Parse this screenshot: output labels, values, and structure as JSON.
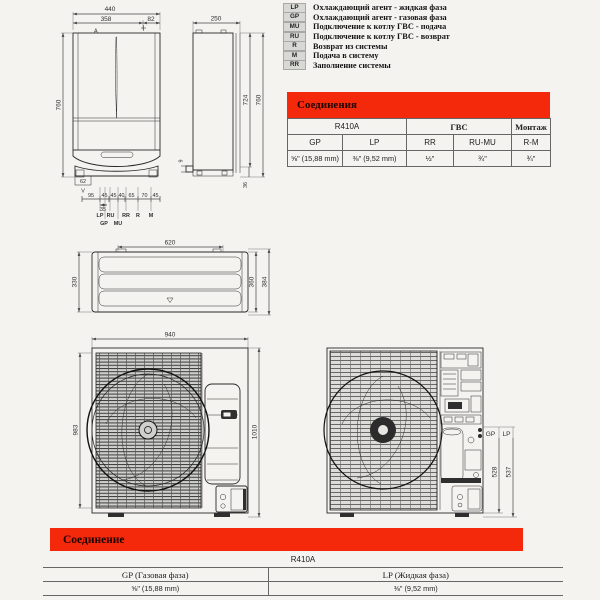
{
  "colors": {
    "accent_red": "#f4290c"
  },
  "legend": {
    "items": [
      {
        "key": "LP",
        "desc": "Охлаждающий агент - жидкая фаза"
      },
      {
        "key": "GP",
        "desc": "Охлаждающий агент - газовая фаза"
      },
      {
        "key": "MU",
        "desc": "Подключение к котлу ГВС - подача"
      },
      {
        "key": "RU",
        "desc": "Подключение к котлу ГВС - возврат"
      },
      {
        "key": "R",
        "desc": "Возврат из системы"
      },
      {
        "key": "M",
        "desc": "Подача в систему"
      },
      {
        "key": "RR",
        "desc": "Заполнение системы"
      }
    ]
  },
  "top_table": {
    "title": "Соединения",
    "group_r410a": "R410A",
    "group_gvs": "ГВС",
    "group_montage": "Монтаж",
    "col_headers": [
      "GP",
      "LP",
      "RR",
      "RU-MU",
      "R-M"
    ],
    "values": [
      "⅝\" (15,88 mm)",
      "⅜\" (9,52 mm)",
      "½\"",
      "¾\"",
      "¾\""
    ]
  },
  "bottom_section": {
    "title": "Соединение",
    "refrigerant": "R410A",
    "col_headers": [
      "GP (Газовая фаза)",
      "LP  (Жидкая фаза)"
    ],
    "values": [
      "⅝\" (15,88 mm)",
      "⅜\" (9,52 mm)"
    ]
  },
  "indoor_front": {
    "dims": {
      "total_width": "440",
      "left_width": "358",
      "right_width": "82",
      "height": "760",
      "bottom_box": "62",
      "v_label": "V",
      "section_marker": "A",
      "sub_dim": "35",
      "bottom_dims": [
        "95",
        "45",
        "45",
        "40",
        "65",
        "70",
        "45"
      ]
    },
    "ports_row1": [
      "LP",
      "RU",
      "RR",
      "R",
      "M"
    ],
    "ports_row2": [
      "GP",
      "MU"
    ]
  },
  "indoor_side": {
    "dims": {
      "depth": "250",
      "inner_height": "724",
      "total_height": "760",
      "pipe": "9",
      "base": "36"
    }
  },
  "outdoor_top": {
    "dims": {
      "inner_width": "620",
      "depth_left": "330",
      "depth_right": "360",
      "depth_total": "384"
    }
  },
  "outdoor_front": {
    "dims": {
      "width": "940",
      "height_left": "983",
      "height_right": "1010"
    }
  },
  "outdoor_internal": {
    "labels": {
      "gp": "GP",
      "lp": "LP"
    },
    "dims": {
      "gp_height": "528",
      "lp_height": "537"
    }
  }
}
